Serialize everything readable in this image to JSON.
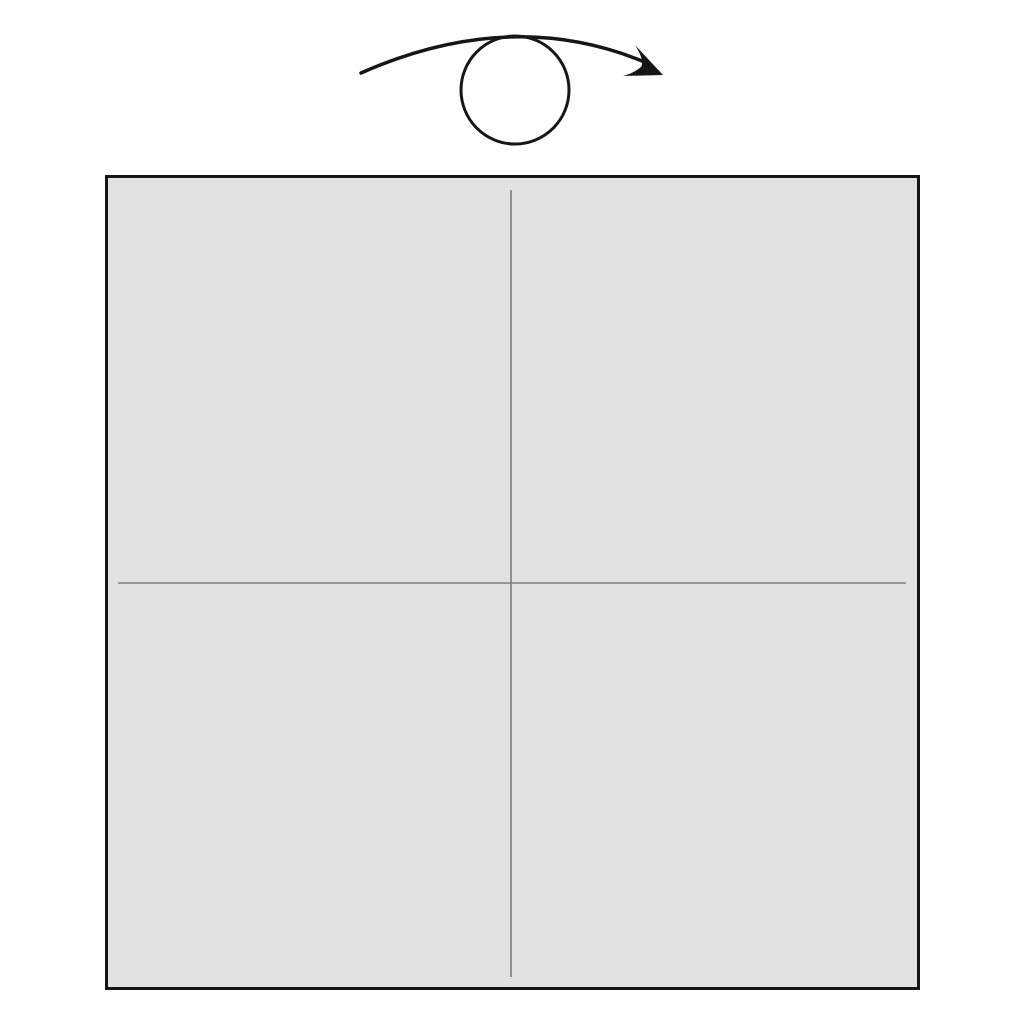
{
  "diagram": {
    "name": "origami-step-diagram",
    "background": "#ffffff"
  },
  "turn_over_symbol": {
    "name": "turn-over-arrow",
    "color": "#161616"
  },
  "paper": {
    "fill": "#e2e2e2",
    "outline_color": "#161616",
    "crease_color": "#7d7d7d"
  }
}
